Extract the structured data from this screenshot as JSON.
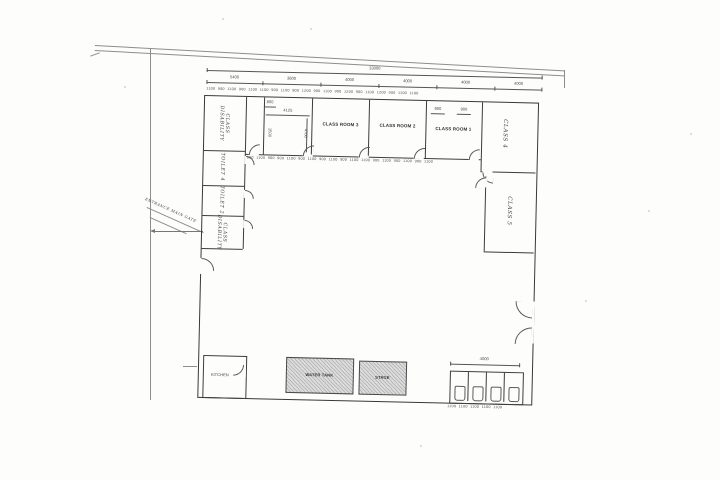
{
  "plan": {
    "rooms": {
      "class_disability_top": "CLASS\nDISABILITY",
      "toilet4": "TOILET 4",
      "toilet2": "TOILET 2",
      "class_disability_bottom": "CLASS\nDISABILITY",
      "classroom3": "CLASS ROOM 3",
      "classroom2": "CLASS ROOM 2",
      "classroom1": "CLASS ROOM 1",
      "class4": "CLASS 4",
      "class5": "CLASS 5",
      "kitchen": "KITCHEN",
      "water_tank": "WATER TANK",
      "stage": "STAGE"
    },
    "annotations": {
      "entrance_gate": "ENTRANCE MAIN GATE"
    },
    "dims": {
      "overall": "33000",
      "segments": [
        "5400",
        "3600",
        "4000",
        "4000",
        "4000",
        "4000"
      ],
      "top_small_row": "1100 900 1100 900 1100 1100 900 1100 900 1200 900 1100 900 1200 900 1100 1200 900 1100 1100",
      "front_small_row": "900 1100 900 900 1100 900 1100 900 1100 900 1100 1100 900 1100 900 1100 900 1100",
      "room_width": "4125",
      "room_height": "4700",
      "room_d1": "800",
      "room_d2": "1500",
      "class1_d1": "900",
      "class1_d2": "900",
      "toilet_block_width": "4000",
      "toilet_small_row": "1100 1100 1100 1100 1100"
    },
    "colors": {
      "ink": "#3c3c3c",
      "faint_line": "#8d8d8d",
      "hatch_fill": "#dcdcdc"
    }
  }
}
